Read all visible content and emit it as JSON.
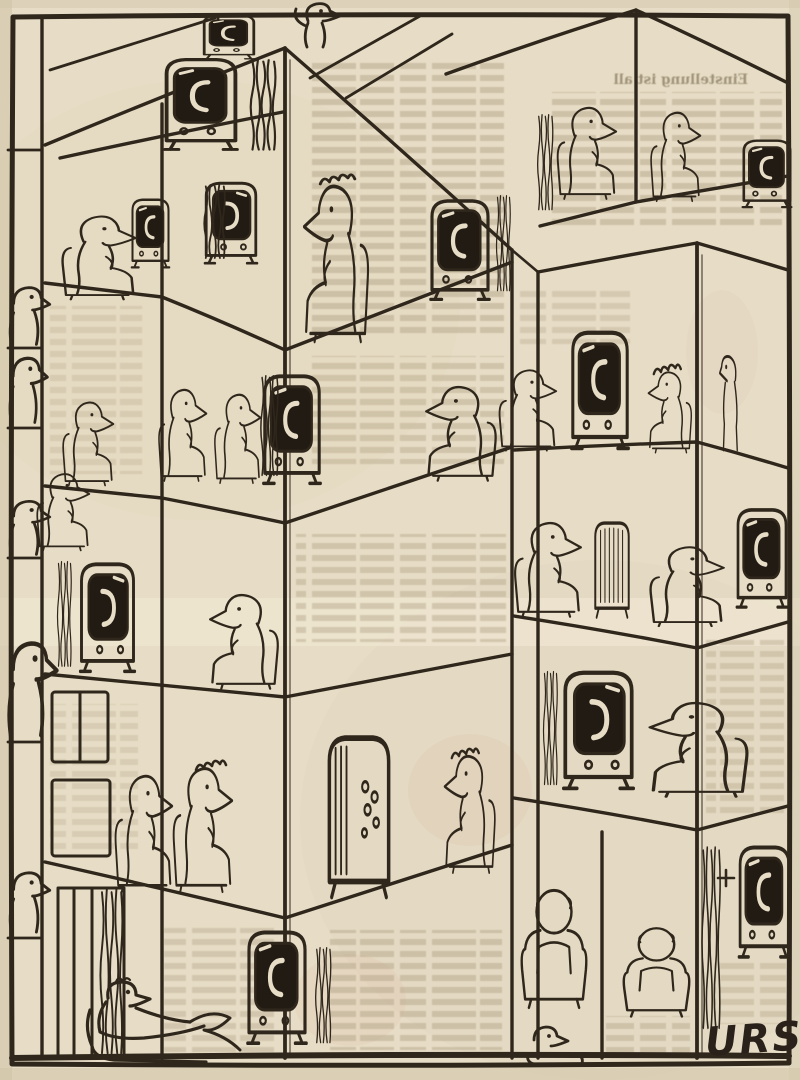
{
  "artwork": {
    "type": "scanned newspaper cartoon",
    "signature": "URS",
    "bleed_through": {
      "headline_fragment": "Einstellung ist all",
      "note": "mirrored newsprint text showing through the paper"
    },
    "colors": {
      "paper": "#e7ddc6",
      "ink": "#30271c",
      "screen_dark": "#221b13",
      "bleed_text": "#b3a68a",
      "stain_pink": "#dcb9a9"
    },
    "inventory": {
      "television_sets": 14,
      "figures": 29
    },
    "scene": {
      "description": "Cut-away isometric view of an apartment tower; in almost every room a figure sits in an armchair watching a television set.",
      "rooms": [
        {
          "id": "attic-left",
          "desc": "attic room with television on shelf beside a curtain"
        },
        {
          "id": "roof-top",
          "desc": "small television standing on the roof ridge"
        },
        {
          "id": "roof-stander",
          "desc": "figure standing on the rooftop"
        },
        {
          "id": "left-column-top",
          "desc": "man seated facing right watching the TV at the partition"
        },
        {
          "id": "upper-right-rooms",
          "desc": "two people in armchairs watching the corner television"
        },
        {
          "id": "mid-left-room",
          "desc": "tall curtained television facing the corner"
        },
        {
          "id": "mid-corner-room",
          "desc": "curly-haired person between two television sets"
        },
        {
          "id": "trio-room",
          "desc": "three people in a row watching one television"
        },
        {
          "id": "window-figure",
          "desc": "small figure at a window sill"
        },
        {
          "id": "armchair-room",
          "desc": "person sunk in an armchair facing left"
        },
        {
          "id": "facing-left-room",
          "desc": "man in armchair facing the television across the partition"
        },
        {
          "id": "left-column-tv",
          "desc": "television facing right through the partition"
        },
        {
          "id": "right-tower-mid",
          "desc": "man watching TV while two neighbours stand behind it"
        },
        {
          "id": "tv-back-room",
          "desc": "man watching the back of a television"
        },
        {
          "id": "right-face-room",
          "desc": "person in a low chair watching the television"
        },
        {
          "id": "crossed-legs-room",
          "desc": "man with crossed legs watching TV beside a curtain"
        },
        {
          "id": "couple-room",
          "desc": "couple seated side by side"
        },
        {
          "id": "tv-back-holes-room",
          "desc": "woman seated behind a television seen from its back panel"
        },
        {
          "id": "recliner-room",
          "desc": "man reclining in an armchair watching television"
        },
        {
          "id": "behind-viewers-room",
          "desc": "two viewers seen from behind"
        },
        {
          "id": "curtain-tv-room",
          "desc": "television beside a tall curtain"
        },
        {
          "id": "bottom-peek",
          "desc": "small head peeking above the bottom frame"
        },
        {
          "id": "edge-strip",
          "desc": "partial neighbours cut off at the left edge of the picture"
        },
        {
          "id": "window-frames",
          "desc": "empty window frames"
        },
        {
          "id": "doorway",
          "desc": "tall doorway with hanging curtain"
        }
      ]
    }
  }
}
